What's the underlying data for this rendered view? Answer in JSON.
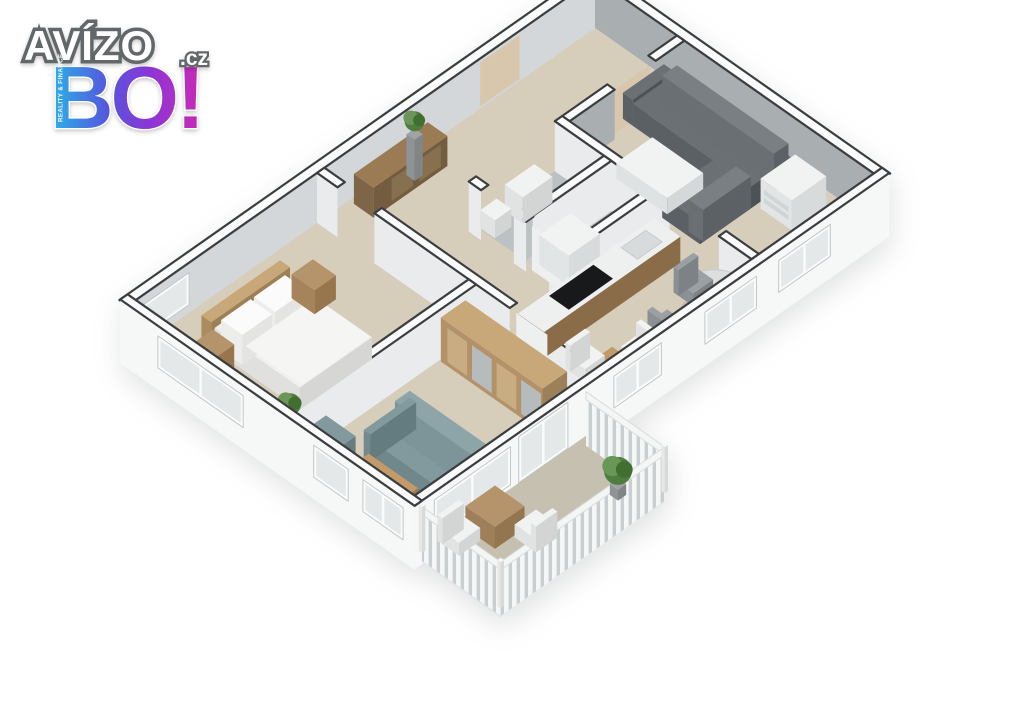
{
  "logo": {
    "title": "AVÍZO",
    "tld": ".cz",
    "sub": "BO!",
    "tagline": "REALITY & FINANCE"
  },
  "colors": {
    "background": "#ffffff",
    "wallTop": "#fbfbfb",
    "wallEdge": "#3a3e40",
    "wallInnerGray": "#a9aeb1",
    "wallInnerLeft": "#d3d7d9",
    "wallFaceLight": "#e9ebec",
    "exteriorFace": "#f6f7f7",
    "floorWood": "#d7cdbb",
    "floorTile": "#bcc1c3",
    "floorTile2": "#c9cdcf",
    "balconyFloor": "#c6c0b1",
    "sofaDark": "#6b7074",
    "sofaDarkBack": "#7a7f83",
    "sofaTeal": "#82999d",
    "sofaTealBack": "#8da4a8",
    "woodLight": "#c8a878",
    "woodMid": "#b5936b",
    "woodDeep": "#8a6f4e",
    "white": "#f1f3f3",
    "black": "#17191b",
    "plant": "#4e7d3f",
    "plantLight": "#6a9757",
    "pot": "#9fa3a5",
    "glass": "#e4e8e9",
    "frame": "#fafbfb",
    "railing": "#f4f6f6",
    "railingShadow": "#c9ced0",
    "doorBeige": "#d8c7ac",
    "mirror": "#b6bcbe",
    "tableGray": "#dcdfe0",
    "chairGray": "#9aa0a3",
    "logoGradient": [
      "#2ab4e9",
      "#5556dc",
      "#8d35d6",
      "#cb2ab4"
    ]
  },
  "floorplan": {
    "type": "3d-floor-plan",
    "rooms": [
      {
        "name": "hallway",
        "furniture": [
          "sideboard",
          "potted-plant",
          "entrance-door",
          "interior-door"
        ]
      },
      {
        "name": "living-room",
        "furniture": [
          "corner-sofa",
          "coffee-table",
          "dresser",
          "dining-table",
          "dining-chair"
        ]
      },
      {
        "name": "bathroom",
        "furniture": [
          "washbasin",
          "toilet",
          "door"
        ]
      },
      {
        "name": "shower-room",
        "furniture": [
          "washing-machine"
        ]
      },
      {
        "name": "kitchen",
        "furniture": [
          "kitchen-counter",
          "cooktop",
          "sink",
          "kitchen-table",
          "kitchen-chair"
        ]
      },
      {
        "name": "corridor",
        "furniture": []
      },
      {
        "name": "bedroom",
        "furniture": [
          "double-bed",
          "headboard",
          "nightstand",
          "potted-plant"
        ]
      },
      {
        "name": "second-room",
        "furniture": [
          "wardrobe",
          "sofa",
          "armchair",
          "coffee-table",
          "potted-plant",
          "door"
        ]
      },
      {
        "name": "balcony",
        "furniture": [
          "bistro-table",
          "chair",
          "potted-plant",
          "railing"
        ]
      }
    ]
  }
}
